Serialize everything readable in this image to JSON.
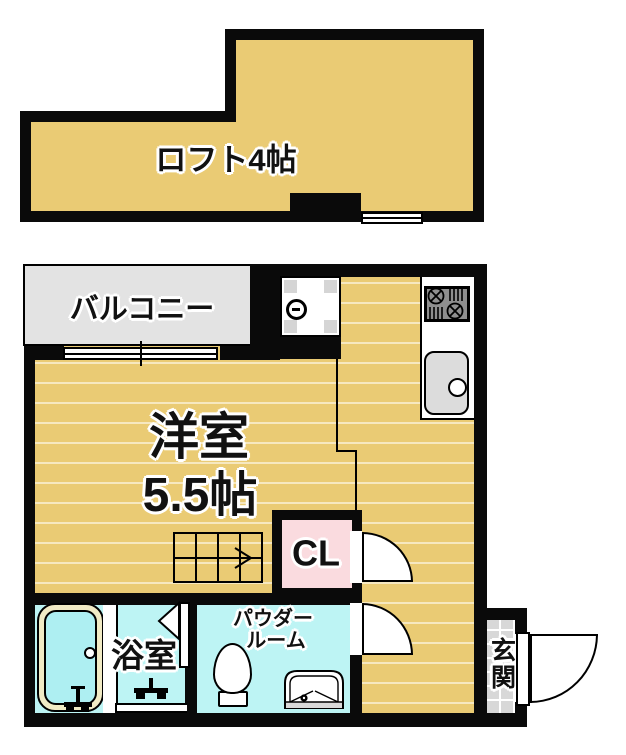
{
  "labels": {
    "loft": "ロフト4帖",
    "balcony": "バルコニー",
    "main_room_line1": "洋室",
    "main_room_line2": "5.5帖",
    "closet": "CL",
    "bath": "浴室",
    "powder_line1": "パウダー",
    "powder_line2": "ルーム",
    "entrance": "玄関"
  },
  "colors": {
    "wall": "#0a0a0a",
    "floor_tan": "#eacb74",
    "balcony_gray": "#e3e3e3",
    "wet_cyan": "#bdf4f4",
    "tub_water": "#aeeff2",
    "tub_rim": "#f1ebc5",
    "closet_pink": "#fadbdf",
    "tile_gray": "#d8d8d8",
    "fixture_gray": "#dcdcdc",
    "stove_gray": "#8f8f8f"
  }
}
